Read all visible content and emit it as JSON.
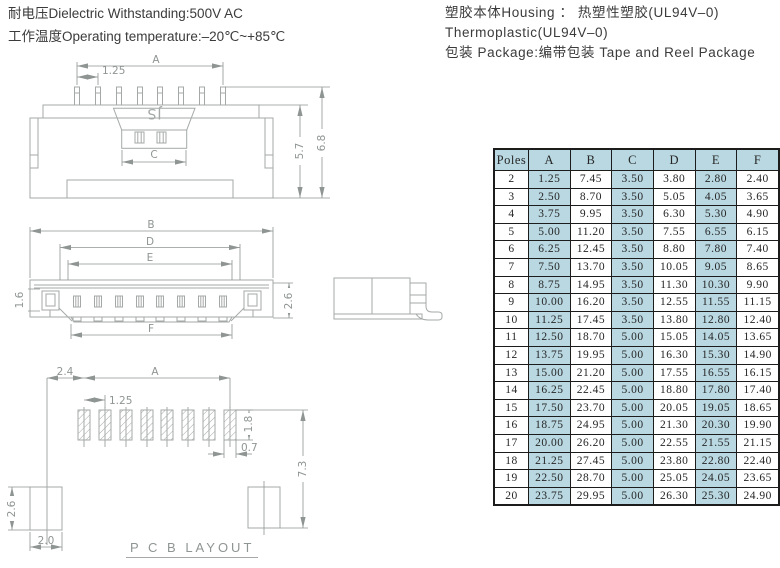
{
  "colors": {
    "line": "#a4a9a7",
    "dimtext": "#8f9593",
    "ink": "#3b3b3b",
    "table_ink": "#262626",
    "table_border": "#1c1c1c",
    "shade_blue": "#b9d8e2"
  },
  "specs": {
    "left": [
      "耐电压Dielectric Withstanding:500V AC",
      "工作温度Operating temperature:–20℃~+85℃"
    ],
    "right": [
      "塑胶本体Housing ： 热塑性塑胶(UL94V–0)",
      "Thermoplastic(UL94V–0)",
      "包装 Package:编带包装 Tape and Reel Package"
    ]
  },
  "drawings": {
    "front": {
      "dim_a": "A",
      "pitch": "1.25",
      "dim_c": "C",
      "h_body": "5.7",
      "h_total": "6.8",
      "logo": "JS"
    },
    "top": {
      "dim_b": "B",
      "dim_d": "D",
      "dim_e": "E",
      "dim_f": "F",
      "h_left": "1.6",
      "h_right": "2.6"
    },
    "pcb": {
      "title": "P C B LAYOUT",
      "offset": "2.4",
      "dim_a": "A",
      "pitch": "1.25",
      "pad_h": "1.8",
      "pad_w": "0.7",
      "row_gap": "7.3",
      "anchor_h": "2.6",
      "anchor_w": "2.0"
    }
  },
  "table": {
    "headers": [
      "Poles",
      "A",
      "B",
      "C",
      "D",
      "E",
      "F"
    ],
    "shaded_columns": [
      1,
      3,
      5
    ],
    "rows": [
      [
        "2",
        "1.25",
        "7.45",
        "3.50",
        "3.80",
        "2.80",
        "2.40"
      ],
      [
        "3",
        "2.50",
        "8.70",
        "3.50",
        "5.05",
        "4.05",
        "3.65"
      ],
      [
        "4",
        "3.75",
        "9.95",
        "3.50",
        "6.30",
        "5.30",
        "4.90"
      ],
      [
        "5",
        "5.00",
        "11.20",
        "3.50",
        "7.55",
        "6.55",
        "6.15"
      ],
      [
        "6",
        "6.25",
        "12.45",
        "3.50",
        "8.80",
        "7.80",
        "7.40"
      ],
      [
        "7",
        "7.50",
        "13.70",
        "3.50",
        "10.05",
        "9.05",
        "8.65"
      ],
      [
        "8",
        "8.75",
        "14.95",
        "3.50",
        "11.30",
        "10.30",
        "9.90"
      ],
      [
        "9",
        "10.00",
        "16.20",
        "3.50",
        "12.55",
        "11.55",
        "11.15"
      ],
      [
        "10",
        "11.25",
        "17.45",
        "3.50",
        "13.80",
        "12.80",
        "12.40"
      ],
      [
        "11",
        "12.50",
        "18.70",
        "5.00",
        "15.05",
        "14.05",
        "13.65"
      ],
      [
        "12",
        "13.75",
        "19.95",
        "5.00",
        "16.30",
        "15.30",
        "14.90"
      ],
      [
        "13",
        "15.00",
        "21.20",
        "5.00",
        "17.55",
        "16.55",
        "16.15"
      ],
      [
        "14",
        "16.25",
        "22.45",
        "5.00",
        "18.80",
        "17.80",
        "17.40"
      ],
      [
        "15",
        "17.50",
        "23.70",
        "5.00",
        "20.05",
        "19.05",
        "18.65"
      ],
      [
        "16",
        "18.75",
        "24.95",
        "5.00",
        "21.30",
        "20.30",
        "19.90"
      ],
      [
        "17",
        "20.00",
        "26.20",
        "5.00",
        "22.55",
        "21.55",
        "21.15"
      ],
      [
        "18",
        "21.25",
        "27.45",
        "5.00",
        "23.80",
        "22.80",
        "22.40"
      ],
      [
        "19",
        "22.50",
        "28.70",
        "5.00",
        "25.05",
        "24.05",
        "23.65"
      ],
      [
        "20",
        "23.75",
        "29.95",
        "5.00",
        "26.30",
        "25.30",
        "24.90"
      ]
    ]
  }
}
